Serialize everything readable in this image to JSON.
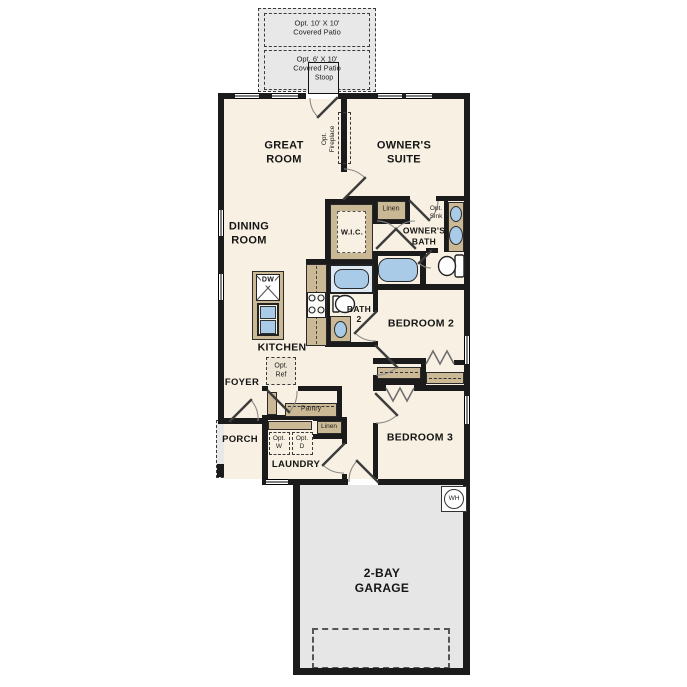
{
  "plan": {
    "patio_option_1": {
      "line1": "Opt. 10' X 10'",
      "line2": "Covered Patio"
    },
    "patio_option_2": {
      "line1": "Opt. 6' X 10'",
      "line2": "Covered Patio"
    },
    "stoop": "Stoop",
    "great_room": {
      "line1": "GREAT",
      "line2": "ROOM"
    },
    "owners_suite": {
      "line1": "OWNER'S",
      "line2": "SUITE"
    },
    "opt_fireplace": {
      "line1": "Opt.",
      "line2": "Fireplace"
    },
    "dining_room": {
      "line1": "DINING",
      "line2": "ROOM"
    },
    "wic": "W.I.C.",
    "linen_owners": "Linen",
    "opt_sink": {
      "line1": "Opt.",
      "line2": "Sink"
    },
    "owners_bath": {
      "line1": "OWNER'S",
      "line2": "BATH"
    },
    "kitchen": "KITCHEN",
    "dishwasher": "DW",
    "bath2": {
      "line1": "BATH",
      "line2": "2"
    },
    "bedroom2": "BEDROOM 2",
    "bedroom3": "BEDROOM 3",
    "foyer": "FOYER",
    "opt_ref": {
      "line1": "Opt.",
      "line2": "Ref"
    },
    "pantry": "Pantry",
    "linen_hall": "Linen",
    "porch": "PORCH",
    "opt_washer": {
      "line1": "Opt.",
      "line2": "W"
    },
    "opt_dryer": {
      "line1": "Opt.",
      "line2": "D"
    },
    "laundry": "LAUNDRY",
    "garage": {
      "line1": "2-BAY",
      "line2": "GARAGE"
    },
    "water_heater": "WH"
  },
  "colors": {
    "floor": "#f8f0e2",
    "wall": "#1b1b1b",
    "cabinet_tan": "#cbb996",
    "fixture_blue": "#a9cbe7",
    "exterior_gray": "#e8e8e8",
    "door_swing": "#8a8a8a"
  }
}
